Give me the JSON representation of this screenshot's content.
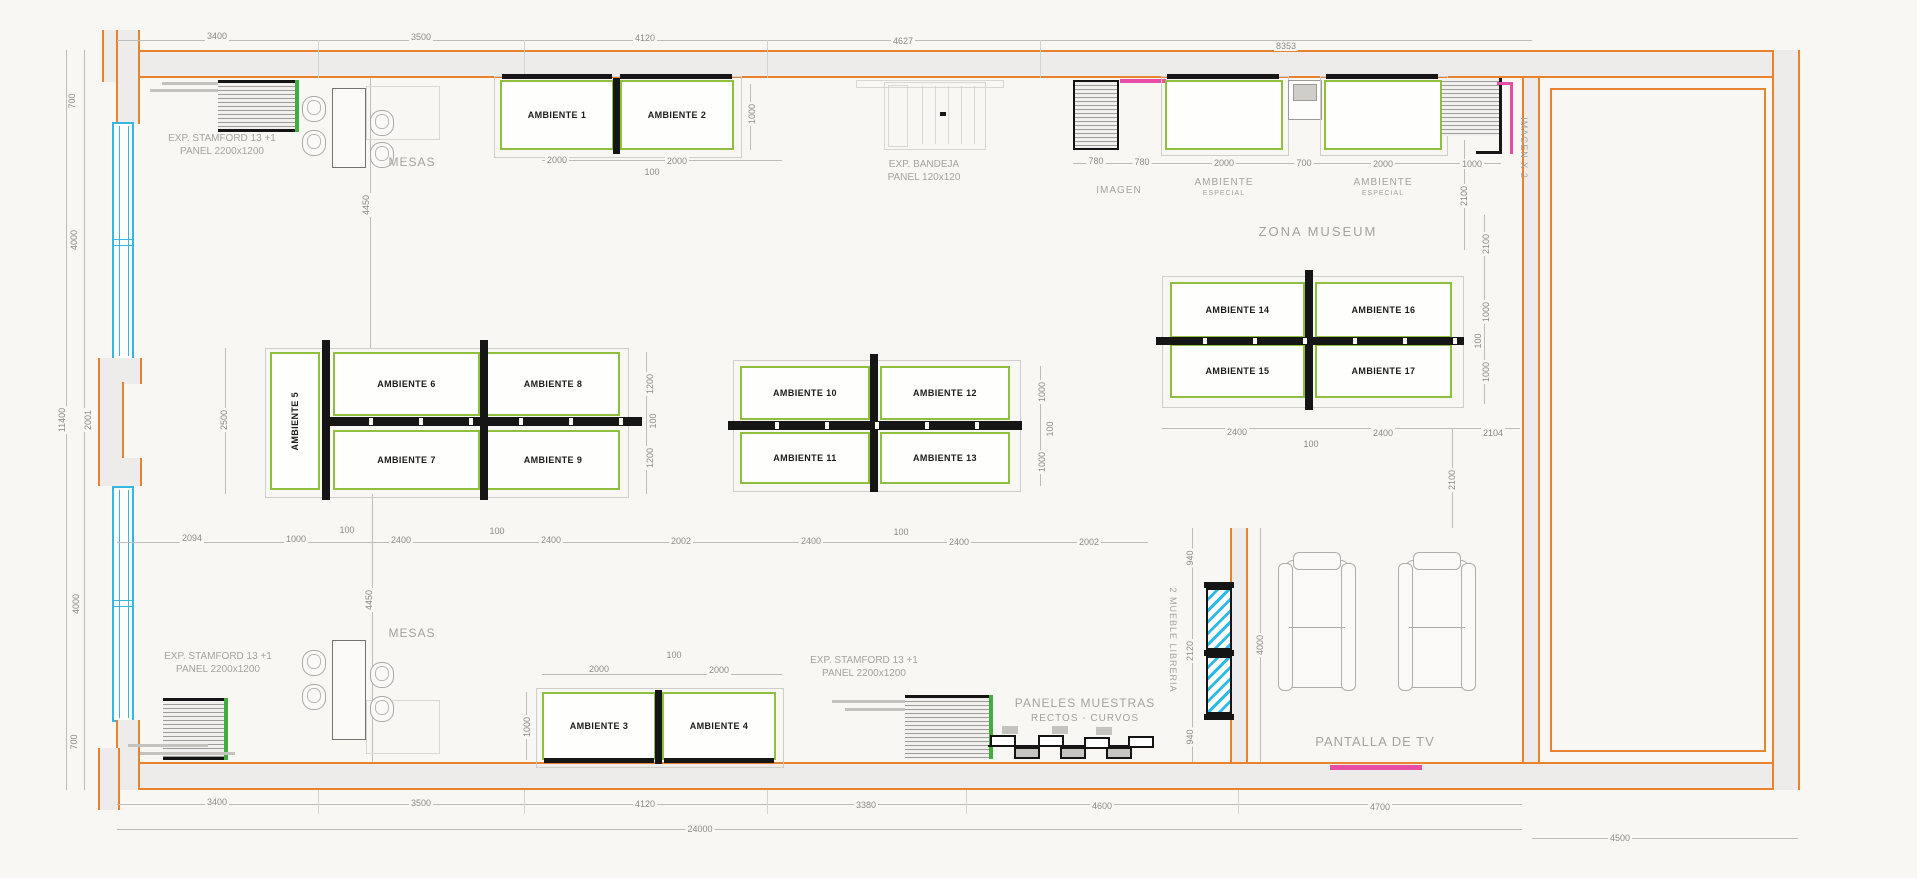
{
  "drawing": {
    "title": "exhibition floor plan",
    "colors": {
      "wall_orange": "#e8822e",
      "wall_fill": "#edecea",
      "window_cyan": "#35b7e4",
      "booth_green": "#8fbf3f",
      "partition_black": "#161616",
      "accent_magenta": "#e84da6",
      "dim_text": "#8c8b87",
      "label_text": "#a4a39d",
      "paper": "#f8f7f4"
    },
    "ambientes": [
      "AMBIENTE 1",
      "AMBIENTE 2",
      "AMBIENTE 3",
      "AMBIENTE 4",
      "AMBIENTE 5",
      "AMBIENTE 6",
      "AMBIENTE 7",
      "AMBIENTE 8",
      "AMBIENTE 9",
      "AMBIENTE 10",
      "AMBIENTE 11",
      "AMBIENTE 12",
      "AMBIENTE 13",
      "AMBIENTE 14",
      "AMBIENTE 15",
      "AMBIENTE 16",
      "AMBIENTE 17"
    ],
    "area_labels": [
      {
        "name": "exp-stamford-top-left-label",
        "lines": [
          "EXP. STAMFORD 13 +1",
          "PANEL 2200x1200"
        ],
        "x": 222,
        "y": 132,
        "fs": 10
      },
      {
        "name": "mesas-top-label",
        "lines": [
          "MESAS"
        ],
        "x": 412,
        "y": 155,
        "fs": 12,
        "ls": 1
      },
      {
        "name": "exp-bandeja-label",
        "lines": [
          "EXP. BANDEJA",
          "PANEL 120x120"
        ],
        "x": 924,
        "y": 158,
        "fs": 10
      },
      {
        "name": "imagen-label",
        "lines": [
          "IMAGEN"
        ],
        "x": 1119,
        "y": 184,
        "fs": 10,
        "ls": 1
      },
      {
        "name": "ambiente-especial-1-label",
        "lines": [
          "AMBIENTE",
          "ESPECIAL"
        ],
        "x": 1224,
        "y": 176,
        "fs": 10,
        "fs2": 7,
        "ls": 1
      },
      {
        "name": "ambiente-especial-2-label",
        "lines": [
          "AMBIENTE",
          "ESPECIAL"
        ],
        "x": 1383,
        "y": 176,
        "fs": 10,
        "fs2": 7,
        "ls": 1
      },
      {
        "name": "zona-museum-label",
        "lines": [
          "ZONA MUSEUM"
        ],
        "x": 1318,
        "y": 224,
        "fs": 13,
        "ls": 2
      },
      {
        "name": "imagen-x2-label",
        "lines": [
          "IMAGEN X 2"
        ],
        "x": 1523,
        "y": 148,
        "fs": 9,
        "ls": 1,
        "rot": 90
      },
      {
        "name": "mesas-bottom-label",
        "lines": [
          "MESAS"
        ],
        "x": 412,
        "y": 626,
        "fs": 12,
        "ls": 1
      },
      {
        "name": "exp-stamford-bottom-left-label",
        "lines": [
          "EXP. STAMFORD 13 +1",
          "PANEL 2200x1200"
        ],
        "x": 218,
        "y": 650,
        "fs": 10
      },
      {
        "name": "exp-stamford-bottom-right-label",
        "lines": [
          "EXP. STAMFORD 13 +1",
          "PANEL 2200x1200"
        ],
        "x": 864,
        "y": 654,
        "fs": 10
      },
      {
        "name": "paneles-muestras-label",
        "lines": [
          "PANELES MUESTRAS",
          "RECTOS - CURVOS"
        ],
        "x": 1085,
        "y": 696,
        "fs": 12,
        "fs2": 10,
        "ls": 1
      },
      {
        "name": "mueble-libreria-label",
        "lines": [
          "2 MUEBLE LIBRERIA"
        ],
        "x": 1172,
        "y": 640,
        "fs": 9,
        "ls": 1,
        "rot": 90
      },
      {
        "name": "pantalla-tv-label",
        "lines": [
          "PANTALLA DE TV"
        ],
        "x": 1375,
        "y": 734,
        "fs": 13,
        "ls": 1
      }
    ],
    "dimensions": [
      {
        "v": "3400",
        "x": 217,
        "y": 36
      },
      {
        "v": "3500",
        "x": 421,
        "y": 37
      },
      {
        "v": "4120",
        "x": 645,
        "y": 38
      },
      {
        "v": "4627",
        "x": 903,
        "y": 41
      },
      {
        "v": "8353",
        "x": 1286,
        "y": 46
      },
      {
        "v": "700",
        "x": 72,
        "y": 101,
        "r": 1
      },
      {
        "v": "4000",
        "x": 74,
        "y": 240,
        "r": 1
      },
      {
        "v": "2001",
        "x": 88,
        "y": 420,
        "r": 1
      },
      {
        "v": "11400",
        "x": 62,
        "y": 420,
        "r": 1
      },
      {
        "v": "4000",
        "x": 76,
        "y": 604,
        "r": 1
      },
      {
        "v": "700",
        "x": 74,
        "y": 742,
        "r": 1
      },
      {
        "v": "2000",
        "x": 557,
        "y": 160
      },
      {
        "v": "100",
        "x": 652,
        "y": 172
      },
      {
        "v": "2000",
        "x": 677,
        "y": 161
      },
      {
        "v": "1000",
        "x": 752,
        "y": 114,
        "r": 1
      },
      {
        "v": "780",
        "x": 1096,
        "y": 161
      },
      {
        "v": "780",
        "x": 1142,
        "y": 162
      },
      {
        "v": "2000",
        "x": 1224,
        "y": 163
      },
      {
        "v": "700",
        "x": 1304,
        "y": 163
      },
      {
        "v": "2000",
        "x": 1383,
        "y": 164
      },
      {
        "v": "1000",
        "x": 1472,
        "y": 164
      },
      {
        "v": "2100",
        "x": 1464,
        "y": 196,
        "r": 1
      },
      {
        "v": "2100",
        "x": 1486,
        "y": 244,
        "r": 1
      },
      {
        "v": "1000",
        "x": 1486,
        "y": 312,
        "r": 1
      },
      {
        "v": "100",
        "x": 1478,
        "y": 341,
        "r": 1
      },
      {
        "v": "1000",
        "x": 1486,
        "y": 372,
        "r": 1
      },
      {
        "v": "2400",
        "x": 1237,
        "y": 432
      },
      {
        "v": "100",
        "x": 1311,
        "y": 444
      },
      {
        "v": "2400",
        "x": 1383,
        "y": 433
      },
      {
        "v": "2104",
        "x": 1493,
        "y": 433
      },
      {
        "v": "2100",
        "x": 1452,
        "y": 480,
        "r": 1
      },
      {
        "v": "4450",
        "x": 366,
        "y": 205,
        "r": 1
      },
      {
        "v": "2500",
        "x": 224,
        "y": 420,
        "r": 1
      },
      {
        "v": "1200",
        "x": 650,
        "y": 384,
        "r": 1
      },
      {
        "v": "100",
        "x": 653,
        "y": 421,
        "r": 1
      },
      {
        "v": "1200",
        "x": 650,
        "y": 458,
        "r": 1
      },
      {
        "v": "2094",
        "x": 192,
        "y": 538
      },
      {
        "v": "1000",
        "x": 296,
        "y": 539
      },
      {
        "v": "100",
        "x": 347,
        "y": 530
      },
      {
        "v": "2400",
        "x": 401,
        "y": 540
      },
      {
        "v": "100",
        "x": 497,
        "y": 531
      },
      {
        "v": "2400",
        "x": 551,
        "y": 540
      },
      {
        "v": "2002",
        "x": 681,
        "y": 541
      },
      {
        "v": "2400",
        "x": 811,
        "y": 541
      },
      {
        "v": "100",
        "x": 901,
        "y": 532
      },
      {
        "v": "2400",
        "x": 959,
        "y": 542
      },
      {
        "v": "2002",
        "x": 1089,
        "y": 542
      },
      {
        "v": "1000",
        "x": 1042,
        "y": 392,
        "r": 1
      },
      {
        "v": "100",
        "x": 1050,
        "y": 429,
        "r": 1
      },
      {
        "v": "1000",
        "x": 1042,
        "y": 462,
        "r": 1
      },
      {
        "v": "2000",
        "x": 599,
        "y": 669
      },
      {
        "v": "100",
        "x": 674,
        "y": 655
      },
      {
        "v": "2000",
        "x": 719,
        "y": 670
      },
      {
        "v": "1000",
        "x": 527,
        "y": 727,
        "r": 1
      },
      {
        "v": "4450",
        "x": 369,
        "y": 600,
        "r": 1
      },
      {
        "v": "940",
        "x": 1190,
        "y": 558,
        "r": 1
      },
      {
        "v": "2120",
        "x": 1190,
        "y": 651,
        "r": 1
      },
      {
        "v": "940",
        "x": 1190,
        "y": 737,
        "r": 1
      },
      {
        "v": "4000",
        "x": 1260,
        "y": 645,
        "r": 1
      },
      {
        "v": "3400",
        "x": 217,
        "y": 802
      },
      {
        "v": "3500",
        "x": 421,
        "y": 803
      },
      {
        "v": "4120",
        "x": 645,
        "y": 804
      },
      {
        "v": "3380",
        "x": 866,
        "y": 805
      },
      {
        "v": "4600",
        "x": 1102,
        "y": 806
      },
      {
        "v": "4700",
        "x": 1380,
        "y": 807
      },
      {
        "v": "24000",
        "x": 700,
        "y": 829
      },
      {
        "v": "4500",
        "x": 1620,
        "y": 838
      }
    ]
  }
}
